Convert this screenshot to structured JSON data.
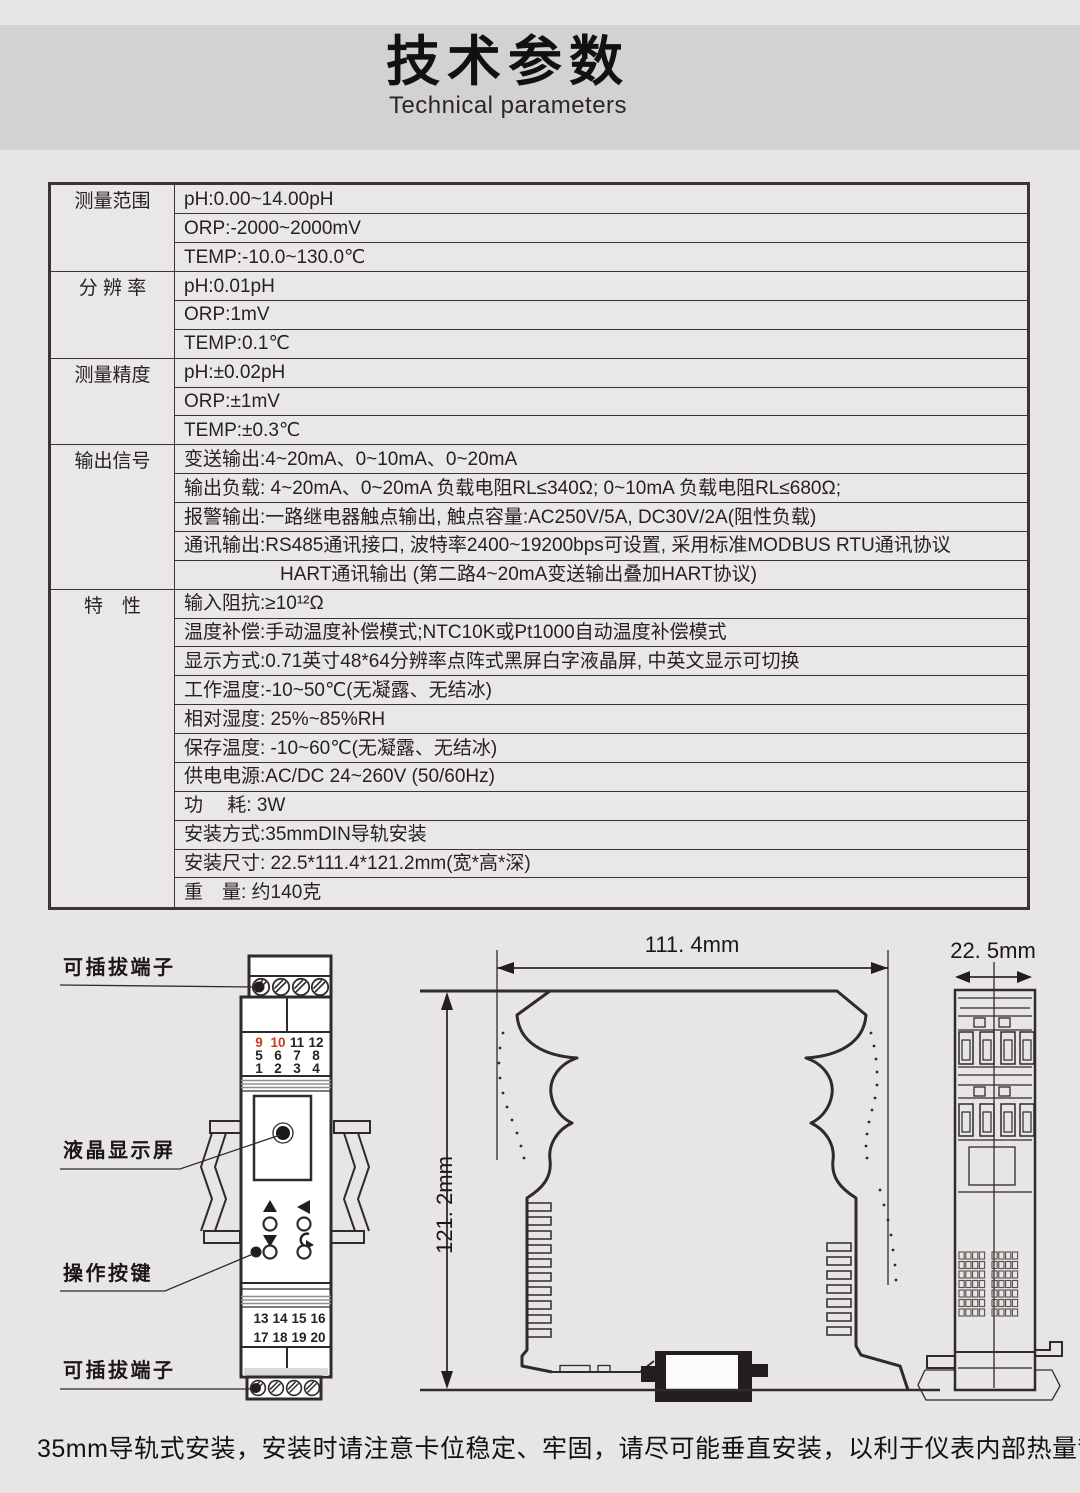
{
  "page": {
    "title_zh": "技术参数",
    "title_en": "Technical parameters",
    "footer_note": "35mm导轨式安装，安装时请注意卡位稳定、牢固，请尽可能垂直安装，以利于仪表内部热量散发。"
  },
  "colors": {
    "page_bg": "#e8e6e5",
    "title_band": "#d4d2d1",
    "table_bg": "#eae8e7",
    "line_dark": "#2f2a2b",
    "accent_red": "#c83a20"
  },
  "table": {
    "groups": [
      {
        "label": "测量范围",
        "rows": [
          {
            "text": "pH:0.00~14.00pH"
          },
          {
            "text": "ORP:-2000~2000mV"
          },
          {
            "text": "TEMP:-10.0~130.0℃"
          }
        ]
      },
      {
        "label": "分 辨 率",
        "rows": [
          {
            "text": "pH:0.01pH"
          },
          {
            "text": "ORP:1mV"
          },
          {
            "text": "TEMP:0.1℃"
          }
        ]
      },
      {
        "label": "测量精度",
        "rows": [
          {
            "text": "pH:±0.02pH"
          },
          {
            "text": "ORP:±1mV"
          },
          {
            "text": "TEMP:±0.3℃"
          }
        ]
      },
      {
        "label": "输出信号",
        "rows": [
          {
            "text": "变送输出:4~20mA、0~10mA、0~20mA"
          },
          {
            "text": "输出负载: 4~20mA、0~20mA 负载电阻RL≤340Ω; 0~10mA 负载电阻RL≤680Ω;"
          },
          {
            "text": "报警输出:一路继电器触点输出, 触点容量:AC250V/5A, DC30V/2A(阻性负载)"
          },
          {
            "text": "通讯输出:RS485通讯接口, 波特率2400~19200bps可设置, 采用标准MODBUS RTU通讯协议"
          },
          {
            "text": "HART通讯输出 (第二路4~20mA变送输出叠加HART协议)",
            "indent": true
          }
        ]
      },
      {
        "label": "特　性",
        "rows": [
          {
            "text": "输入阻抗:≥10¹²Ω"
          },
          {
            "text": "温度补偿:手动温度补偿模式;NTC10K或Pt1000自动温度补偿模式"
          },
          {
            "text": "显示方式:0.71英寸48*64分辨率点阵式黑屏白字液晶屏, 中英文显示可切换"
          },
          {
            "text": "工作温度:-10~50℃(无凝露、无结冰)"
          },
          {
            "text": "相对湿度: 25%~85%RH"
          },
          {
            "text": "保存温度: -10~60℃(无凝露、无结冰)"
          },
          {
            "text": "供电电源:AC/DC 24~260V (50/60Hz)"
          },
          {
            "text": "功　 耗: 3W"
          },
          {
            "text": "安装方式:35mmDIN导轨安装"
          },
          {
            "text": "安装尺寸: 22.5*111.4*121.2mm(宽*高*深)"
          },
          {
            "text": "重　量: 约140克"
          }
        ]
      }
    ]
  },
  "diagram": {
    "callouts": {
      "terminal_top": "可插拔端子",
      "lcd": "液晶显示屏",
      "buttons": "操作按键",
      "terminal_bottom": "可插拔端子"
    },
    "dimensions": {
      "width": "111. 4mm",
      "height": "121. 2mm",
      "depth": "22. 5mm"
    },
    "terminal_numbers_top": [
      [
        "9",
        "10",
        "11",
        "12"
      ],
      [
        "5",
        "6",
        "7",
        "8"
      ],
      [
        "1",
        "2",
        "3",
        "4"
      ]
    ],
    "terminal_numbers_bottom": [
      [
        "13",
        "14",
        "15",
        "16"
      ],
      [
        "17",
        "18",
        "19",
        "20"
      ]
    ],
    "red_terminal_numbers": [
      "9",
      "10"
    ]
  }
}
